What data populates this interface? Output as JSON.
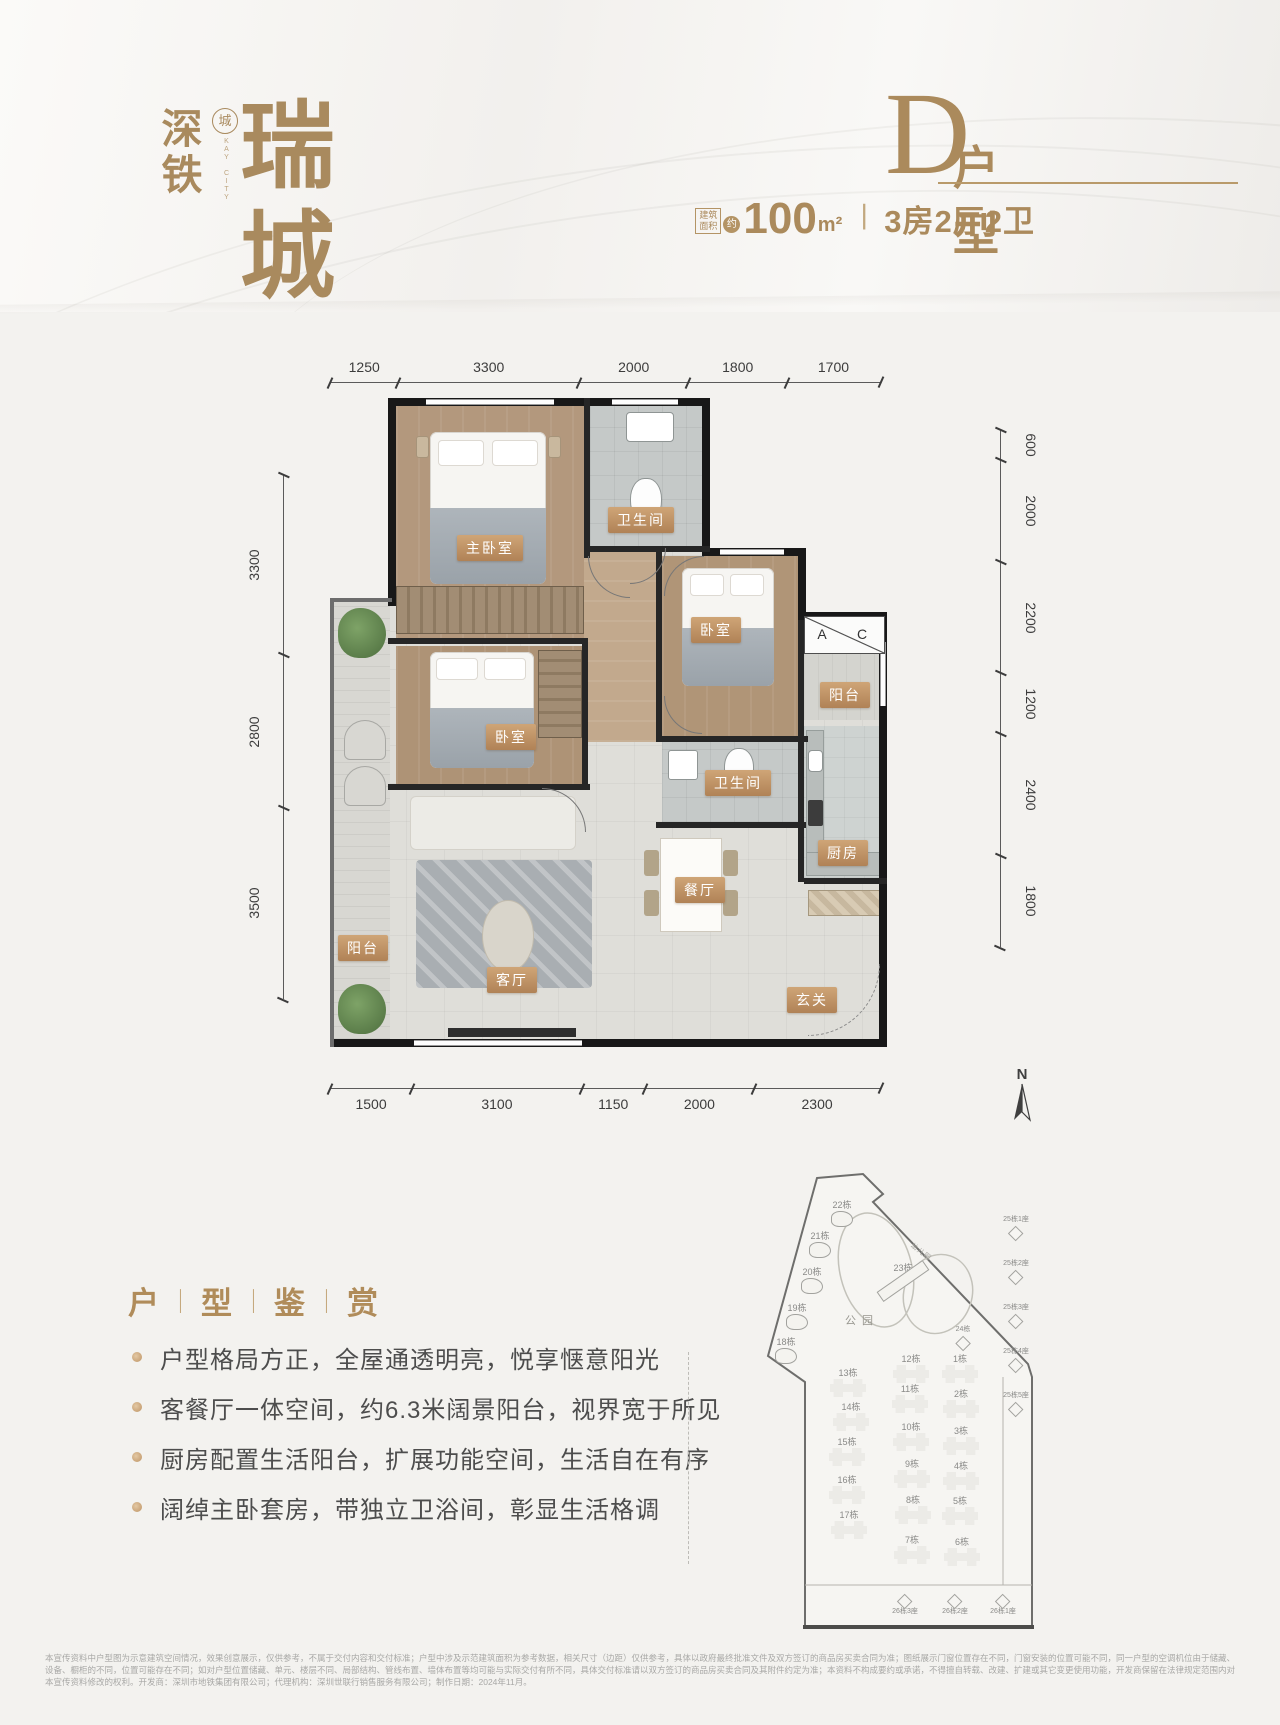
{
  "logo": {
    "char1": "深",
    "char2": "铁",
    "seal": "城",
    "seal_sub": "KAY CITY",
    "main": "瑞城"
  },
  "title": {
    "letter": "D",
    "suffix": "户型",
    "area_label_line1": "建筑",
    "area_label_line2": "面积",
    "approx": "约",
    "area_value": "100",
    "area_unit": "m²",
    "separator": "丨",
    "spec": "3房2厅2卫",
    "accent_color": "#ab8a5c"
  },
  "floorplan": {
    "dims_top": [
      1250,
      3300,
      2000,
      1800,
      1700
    ],
    "dims_left": [
      3300,
      2800,
      3500
    ],
    "dims_right": [
      600,
      2000,
      2200,
      1200,
      2400,
      1800
    ],
    "dims_bottom": [
      1500,
      3100,
      1150,
      2000,
      2300
    ],
    "room_labels": [
      {
        "label": "主卧室",
        "x": 490,
        "y": 548
      },
      {
        "label": "卫生间",
        "x": 641,
        "y": 520
      },
      {
        "label": "卧室",
        "x": 716,
        "y": 630
      },
      {
        "label": "卧室",
        "x": 511,
        "y": 737
      },
      {
        "label": "卫生间",
        "x": 738,
        "y": 783
      },
      {
        "label": "阳台",
        "x": 845,
        "y": 695
      },
      {
        "label": "厨房",
        "x": 843,
        "y": 853
      },
      {
        "label": "餐厅",
        "x": 700,
        "y": 890
      },
      {
        "label": "客厅",
        "x": 512,
        "y": 980
      },
      {
        "label": "阳台",
        "x": 363,
        "y": 948
      },
      {
        "label": "玄关",
        "x": 812,
        "y": 1000
      }
    ],
    "ac_markers": [
      {
        "label": "A",
        "x": 822,
        "y": 634
      },
      {
        "label": "C",
        "x": 862,
        "y": 634
      }
    ],
    "wall_color": "#181818",
    "label_badge_color": "#bd8f60"
  },
  "features": {
    "heading": [
      "户",
      "型",
      "鉴",
      "赏"
    ],
    "bullets": [
      "户型格局方正，全屋通透明亮，悦享惬意阳光",
      "客餐厅一体空间，约6.3米阔景阳台，视界宽于所见",
      "厨房配置生活阳台，扩展功能空间，生活自在有序",
      "阔绰主卧套房，带独立卫浴间，彰显生活格调"
    ]
  },
  "sitemap": {
    "north_label": "N",
    "park_label": "公园",
    "kindergarten_label": "幼儿园",
    "towers": [
      {
        "label": "22栋",
        "x": 842,
        "y": 1200,
        "type": "s"
      },
      {
        "label": "21栋",
        "x": 820,
        "y": 1231,
        "type": "s"
      },
      {
        "label": "20栋",
        "x": 812,
        "y": 1267,
        "type": "s"
      },
      {
        "label": "19栋",
        "x": 797,
        "y": 1303,
        "type": "s"
      },
      {
        "label": "18栋",
        "x": 786,
        "y": 1337,
        "type": "s"
      },
      {
        "label": "23栋",
        "x": 903,
        "y": 1263,
        "type": "slab"
      },
      {
        "label": "24栋",
        "x": 963,
        "y": 1325,
        "type": "t"
      },
      {
        "label": "13栋",
        "x": 848,
        "y": 1368,
        "type": "m"
      },
      {
        "label": "14栋",
        "x": 851,
        "y": 1402,
        "type": "m"
      },
      {
        "label": "15栋",
        "x": 847,
        "y": 1437,
        "type": "m"
      },
      {
        "label": "16栋",
        "x": 847,
        "y": 1475,
        "type": "m"
      },
      {
        "label": "17栋",
        "x": 849,
        "y": 1510,
        "type": "m"
      },
      {
        "label": "12栋",
        "x": 911,
        "y": 1354,
        "type": "m"
      },
      {
        "label": "11栋",
        "x": 910,
        "y": 1384,
        "type": "m"
      },
      {
        "label": "10栋",
        "x": 911,
        "y": 1422,
        "type": "m"
      },
      {
        "label": "9栋",
        "x": 912,
        "y": 1459,
        "type": "m"
      },
      {
        "label": "8栋",
        "x": 913,
        "y": 1495,
        "type": "m"
      },
      {
        "label": "7栋",
        "x": 912,
        "y": 1535,
        "type": "m"
      },
      {
        "label": "1栋",
        "x": 960,
        "y": 1354,
        "type": "m"
      },
      {
        "label": "2栋",
        "x": 961,
        "y": 1389,
        "type": "m"
      },
      {
        "label": "3栋",
        "x": 961,
        "y": 1426,
        "type": "m"
      },
      {
        "label": "4栋",
        "x": 961,
        "y": 1461,
        "type": "m"
      },
      {
        "label": "5栋",
        "x": 960,
        "y": 1496,
        "type": "m"
      },
      {
        "label": "6栋",
        "x": 962,
        "y": 1537,
        "type": "m"
      },
      {
        "label": "25栋1座",
        "x": 1016,
        "y": 1215,
        "type": "t"
      },
      {
        "label": "25栋2座",
        "x": 1016,
        "y": 1259,
        "type": "t"
      },
      {
        "label": "25栋3座",
        "x": 1016,
        "y": 1303,
        "type": "t"
      },
      {
        "label": "25栋4座",
        "x": 1016,
        "y": 1347,
        "type": "t"
      },
      {
        "label": "25栋5座",
        "x": 1016,
        "y": 1391,
        "type": "t"
      },
      {
        "label": "26栋3座",
        "x": 905,
        "y": 1593,
        "type": "t",
        "flip": true
      },
      {
        "label": "26栋2座",
        "x": 955,
        "y": 1593,
        "type": "t",
        "flip": true
      },
      {
        "label": "26栋1座",
        "x": 1003,
        "y": 1593,
        "type": "t",
        "flip": true
      }
    ]
  },
  "disclaimer": "本宣传资料中户型图为示意建筑空间情况，效果创意展示，仅供参考，不属于交付内容和交付标准；户型中涉及示范建筑面积为参考数据，相关尺寸（边距）仅供参考，具体以政府最终批准文件及双方签订的商品房买卖合同为准；图纸展示门窗位置存在不同，门窗安装的位置可能不同，同一户型的空调机位由于储藏、设备、橱柜的不同，位置可能存在不同；如对户型位置储藏、单元、楼层不同、局部结构、管线布置、墙体布置等均可能与实际交付有所不同，具体交付标准请以双方签订的商品房买卖合同及其附件约定为准；本资料不构成要约或承诺，不得擅自转载、改建、扩建或其它变更使用功能，开发商保留在法律规定范围内对本宣传资料修改的权利。开发商：深圳市地铁集团有限公司；代理机构：深圳世联行销售服务有限公司；制作日期：2024年11月。"
}
